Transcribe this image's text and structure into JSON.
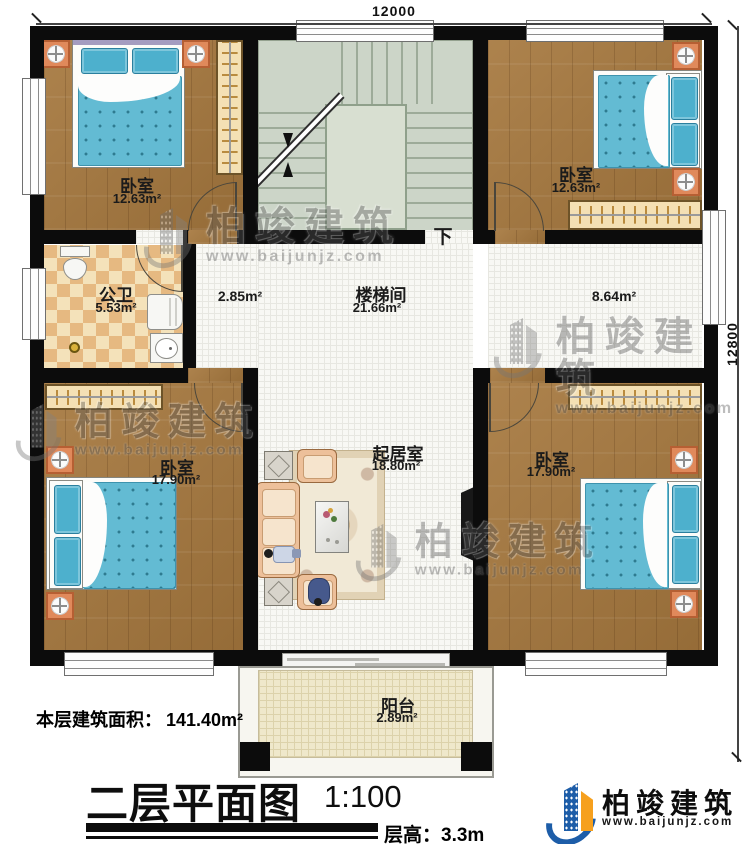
{
  "plan": {
    "dimension_top": "12000",
    "dimension_right": "12800",
    "stairs_direction": "下",
    "rooms": {
      "bedroom_tl": {
        "name": "卧室",
        "area": "12.63m²"
      },
      "bedroom_tr": {
        "name": "卧室",
        "area": "12.63m²"
      },
      "bathroom": {
        "name": "公卫",
        "area": "5.53m²"
      },
      "stair_hall": {
        "name": "楼梯间",
        "area": "21.66m²"
      },
      "hall_west_area": "2.85m²",
      "hall_east_area": "8.64m²",
      "living": {
        "name": "起居室",
        "area": "18.80m²"
      },
      "bedroom_bl": {
        "name": "卧室",
        "area": "17.90m²"
      },
      "bedroom_br": {
        "name": "卧室",
        "area": "17.90m²"
      },
      "balcony": {
        "name": "阳台",
        "area": "2.89m²"
      }
    }
  },
  "footer": {
    "floor_area_label": "本层建筑面积：",
    "floor_area_value": "141.40m²",
    "title": "二层平面图",
    "scale": "1:100",
    "floor_height_label": "层高：",
    "floor_height_value": "3.3m"
  },
  "branding": {
    "company": "柏竣建筑",
    "website": "www.baijunjz.com"
  }
}
